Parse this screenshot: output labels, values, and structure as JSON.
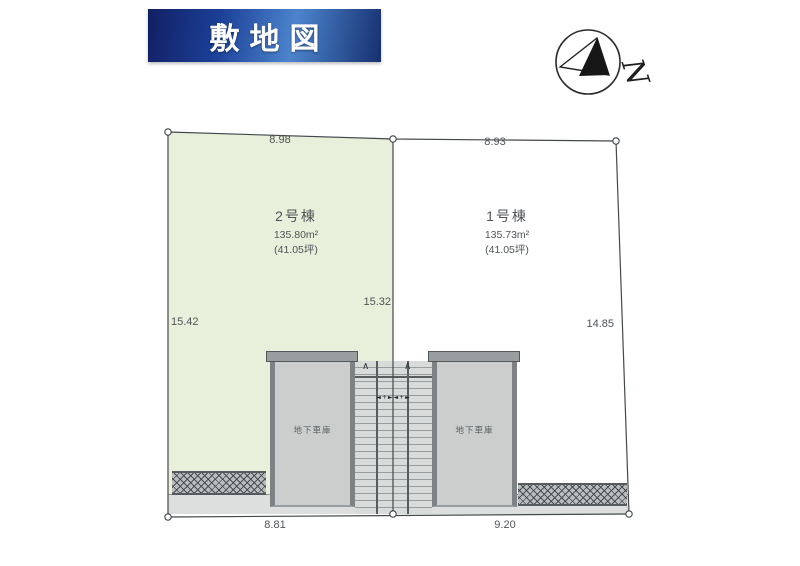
{
  "header": {
    "title": "敷地図"
  },
  "compass": {
    "letter": "N"
  },
  "lots": [
    {
      "name": "2号棟",
      "area": "135.80m²",
      "tsubo": "(41.05坪)"
    },
    {
      "name": "1号棟",
      "area": "135.73m²",
      "tsubo": "(41.05坪)"
    }
  ],
  "dimensions": {
    "top_left": "8.98",
    "top_right": "8.93",
    "left": "15.42",
    "middle": "15.32",
    "right": "14.85",
    "bottom_left": "8.81",
    "bottom_right": "9.20"
  },
  "garages": [
    {
      "label": "地下車庫"
    },
    {
      "label": "地下車庫"
    }
  ],
  "stairs": {
    "up_arrow": "∧",
    "tread_marks": "◄+►◄+►"
  },
  "colors": {
    "banner_dark": "#121f63",
    "banner_light": "#4c84cd",
    "lot2_fill": "#e8efdb",
    "garage_fill": "#cbcecd",
    "garage_wall": "#7d8385",
    "road_fill": "#dddfde",
    "hatch_fill": "#b9bdbe",
    "boundary_line": "#44494c",
    "label_text": "#4f5456"
  }
}
